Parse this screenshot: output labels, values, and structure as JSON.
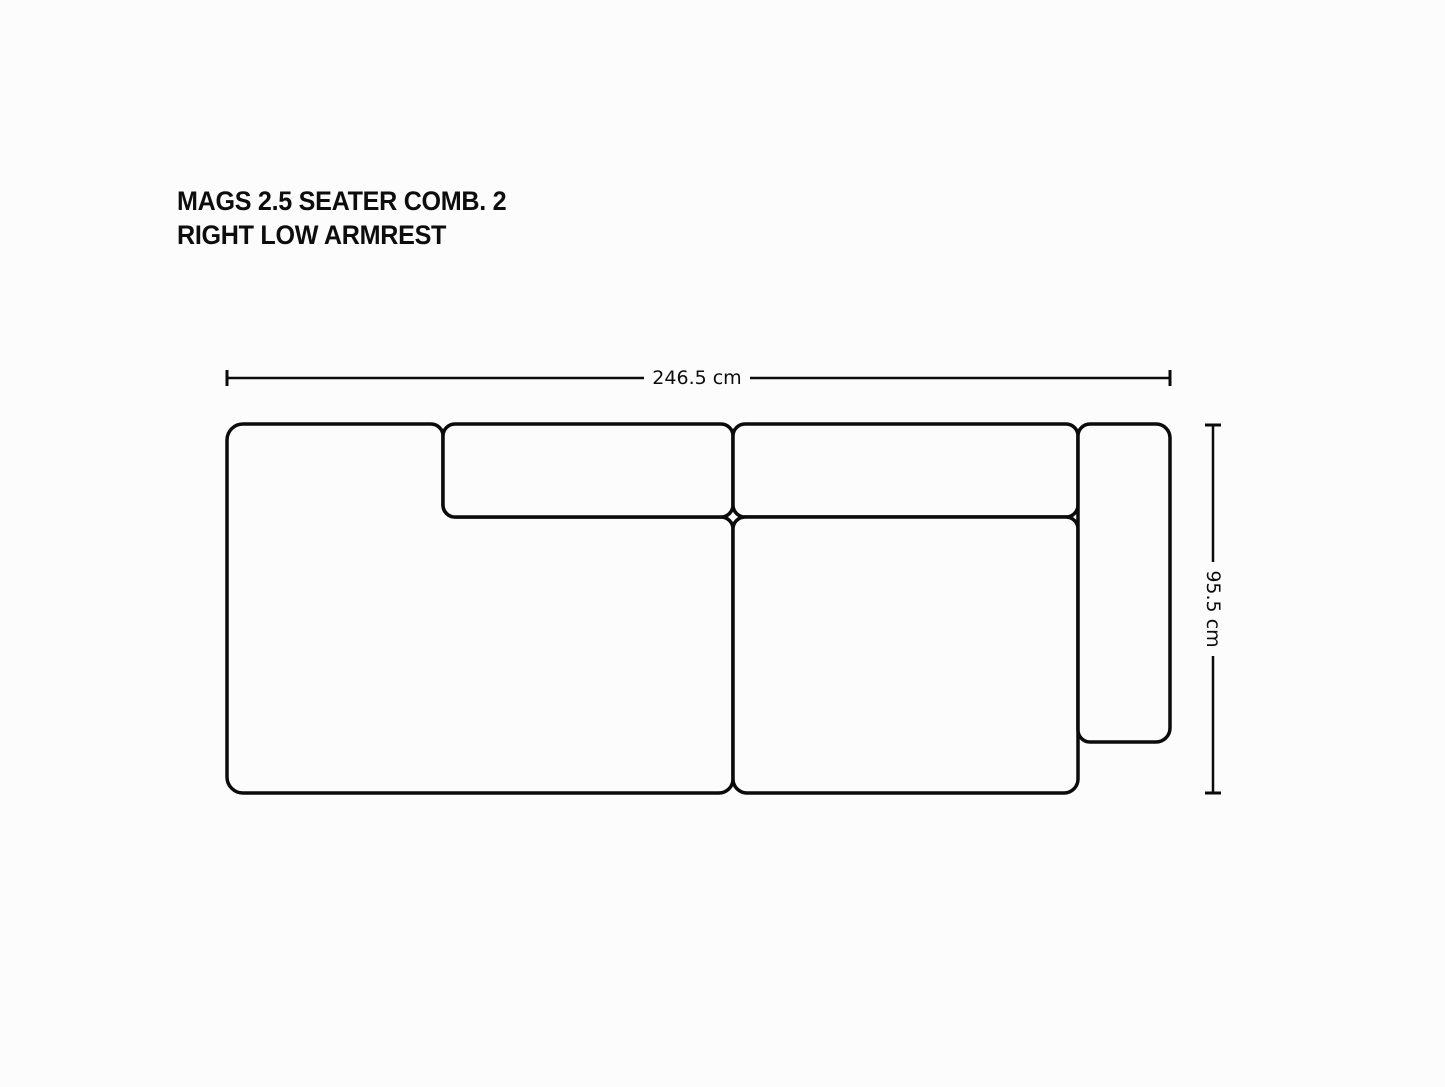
{
  "title": {
    "line1": "MAGS 2.5 SEATER COMB. 2",
    "line2": "RIGHT LOW ARMREST"
  },
  "dimensions": {
    "width_label": "246.5 cm",
    "height_label": "95.5 cm"
  },
  "colors": {
    "background": "#fcfcfc",
    "outline": "#0b0b0b",
    "text": "#0d0d0d"
  }
}
